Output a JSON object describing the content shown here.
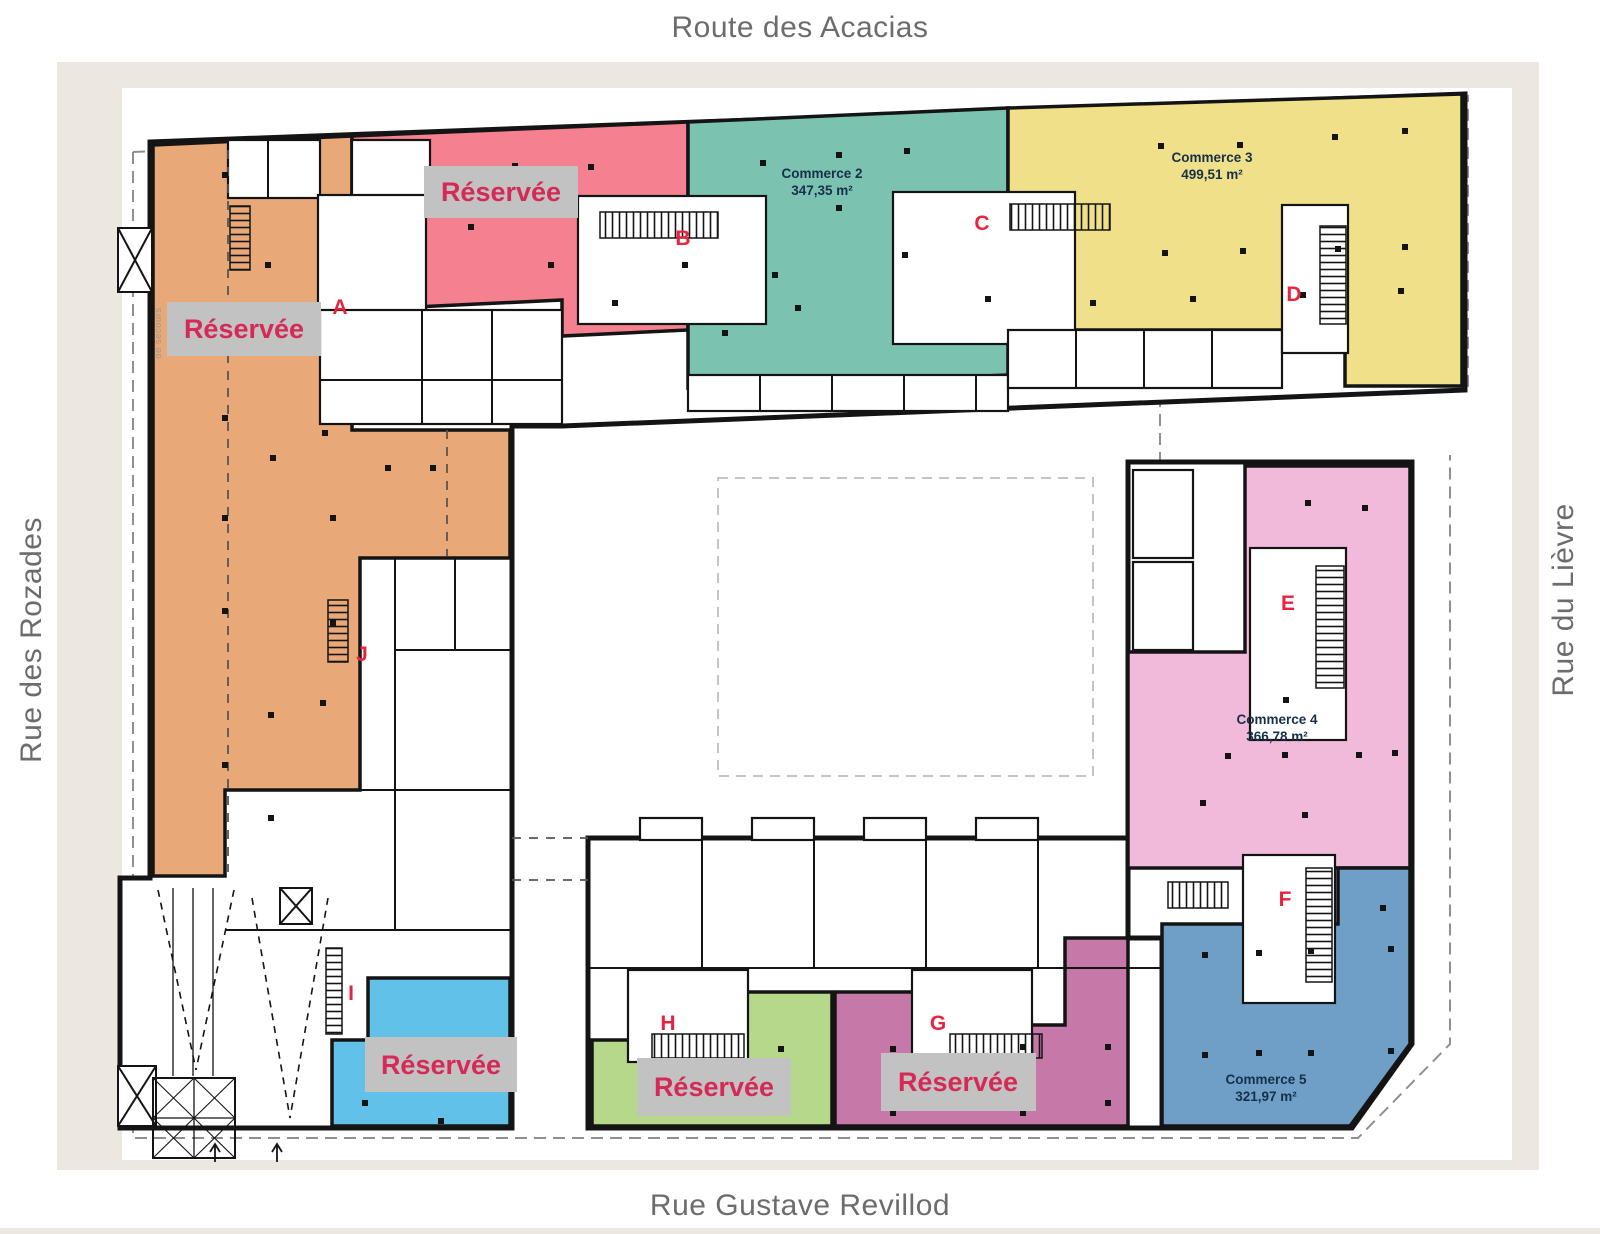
{
  "streets": {
    "top": "Route des Acacias",
    "bottom": "Rue Gustave Revillod",
    "left": "Rue des Rozades",
    "right": "Rue du Lièvre"
  },
  "plan": {
    "reserved_label": "Réservée",
    "commerces": [
      {
        "name": "Commerce 2",
        "area": "347,35 m²"
      },
      {
        "name": "Commerce 3",
        "area": "499,51 m²"
      },
      {
        "name": "Commerce 4",
        "area": "366,78 m²"
      },
      {
        "name": "Commerce 5",
        "area": "321,97 m²"
      }
    ],
    "entrances": [
      "A",
      "B",
      "C",
      "D",
      "E",
      "F",
      "G",
      "H",
      "I",
      "J"
    ],
    "emergency_exit": "de secours"
  },
  "colors": {
    "zone_orange": "#e8a877",
    "zone_pink": "#f5808f",
    "zone_teal": "#7cc2b1",
    "zone_yellow": "#efe089",
    "zone_rose": "#f2bada",
    "zone_blue": "#6f9fc6",
    "zone_sky": "#62c1e8",
    "zone_green": "#b5d88a",
    "zone_plum": "#c679a8",
    "entrance_letter": "#e8233e",
    "reserved_bg": "#c2c2c2",
    "reserved_text": "#d42a55",
    "frame": "#ece8df",
    "wall": "#141414"
  }
}
